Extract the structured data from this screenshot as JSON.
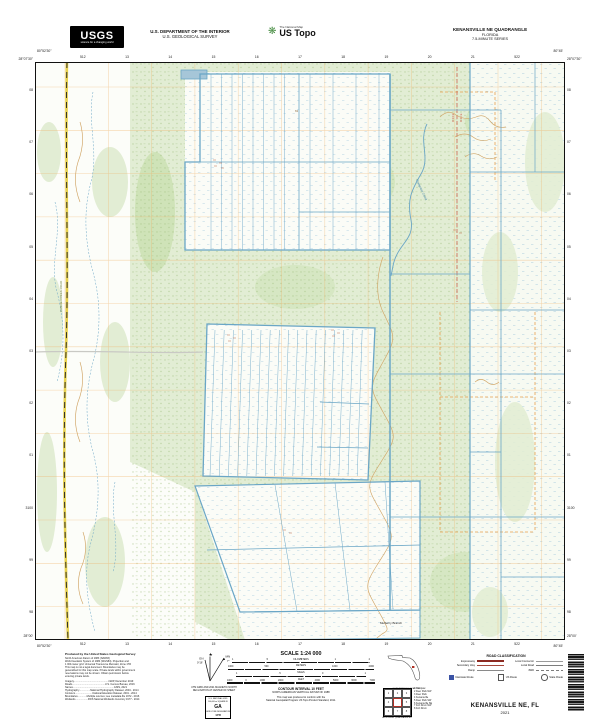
{
  "header": {
    "usgs_logo_text": "USGS",
    "usgs_tagline": "science for a changing world",
    "agency_line1": "U.S. DEPARTMENT OF THE INTERIOR",
    "agency_line2": "U.S. GEOLOGICAL SURVEY",
    "ustopo_brand_small": "The National Map",
    "ustopo_brand_large": "US Topo",
    "quad_title_line1": "KENANSVILLE NE QUADRANGLE",
    "quad_title_line2": "FLORIDA",
    "quad_title_line3": "7.5-MINUTE SERIES"
  },
  "map": {
    "corner_coords": {
      "top_left_lat": "28°07'30\"",
      "top_left_lon": "80°52'30\"",
      "top_right_lat": "28°07'30\"",
      "top_right_lon": "80°45'",
      "bottom_left_lat": "28°00'",
      "bottom_left_lon": "80°52'30\"",
      "bottom_right_lat": "28°00'",
      "bottom_right_lon": "80°45'"
    },
    "edge_labels": {
      "top": [
        "512",
        "13",
        "14",
        "15",
        "16",
        "17",
        "18",
        "19",
        "20",
        "21",
        "522"
      ],
      "bottom": [
        "512",
        "13",
        "14",
        "15",
        "16",
        "17",
        "18",
        "19",
        "20",
        "21",
        "522"
      ],
      "left": [
        "08",
        "07",
        "06",
        "05",
        "04",
        "03",
        "02",
        "01",
        "3100",
        "99",
        "98"
      ],
      "right": [
        "08",
        "07",
        "06",
        "05",
        "04",
        "03",
        "02",
        "01",
        "3100",
        "99",
        "98"
      ]
    },
    "labels": {
      "road_name": "CANOE CREEK ROAD",
      "creek_name": "Crabgrass Creek",
      "branch_name": "Mulberry Branch",
      "spot_elevation": "63",
      "range_left": "R 34 E",
      "range_right": "R 35 E"
    }
  },
  "footer": {
    "produced_by": {
      "title": "Produced by the United States Geological Survey",
      "body_lines": [
        "North American Datum of 1983 (NAD83)",
        "World Geodetic System of 1984 (WGS84). Projection and",
        "1 000-meter grid: Universal Transverse Mercator, Zone 17R",
        "This map is not a legal document. Boundaries may be",
        "generalized for this map scale. Private lands within government",
        "reservations may not be shown. Obtain permission before",
        "entering private lands."
      ],
      "source_lines": [
        "Imagery..................................................NAIP, December 2019",
        "Roads...............................................U.S. Census Bureau, 2016",
        "Names...........................................................GNIS, 2021",
        "Hydrography................National Hydrography Dataset, 2004 - 2014",
        "Contours.........................National Elevation Dataset, 2001 - 2014",
        "Boundaries.............Multiple sources; see metadata file 1972 - 2016",
        "Wetlands..................FWS National Wetlands Inventory 1977 - 2014"
      ]
    },
    "declination": {
      "star_label": "★",
      "gn_label": "GN",
      "gn_value": "0°16'",
      "mn_label": "MN",
      "mn_value": "7°",
      "caption_line1": "UTM GRID AND 2021 MAGNETIC NORTH",
      "caption_line2": "DECLINATION AT CENTER OF SHEET"
    },
    "usng": {
      "line1": "U.S. NATIONAL GRID",
      "line2": "100,000-m SQUARE ID",
      "square_id": "GA",
      "line3": "GRID ZONE DESIGNATION",
      "zone": "17R"
    },
    "scale": {
      "title": "SCALE 1:24 000",
      "bars": [
        {
          "unit": "KILOMETERS",
          "ticks": [
            "1",
            ".5",
            "0",
            "1",
            "2"
          ]
        },
        {
          "unit": "METERS",
          "ticks": [
            "1000",
            "500",
            "0",
            "1000",
            "2000"
          ]
        },
        {
          "unit": "MILES",
          "ticks": [
            "1",
            ".5",
            "0",
            "1"
          ]
        },
        {
          "unit": "FEET",
          "ticks": [
            "1000",
            "0",
            "1000",
            "2000",
            "3000",
            "4000",
            "5000",
            "6000",
            "7000"
          ]
        }
      ],
      "contour_line1": "CONTOUR INTERVAL 10 FEET",
      "contour_line2": "NORTH AMERICAN VERTICAL DATUM OF 1988",
      "standard_line1": "This map was produced to conform with the",
      "standard_line2": "National Geospatial Program US Topo Product Standard, 2011."
    },
    "location_inset": {
      "caption": "QUADRANGLE LOCATION"
    },
    "adjoining": {
      "caption": "ADJOINING QUADRANGLES",
      "names": [
        "Holopaw",
        "Deer Park NW",
        "Deer Park",
        "Kenansville",
        "Deer Park SW",
        "Kenansville SE",
        "Fort Drum NW",
        "Fort Drum"
      ]
    },
    "road_class": {
      "title": "ROAD CLASSIFICATION",
      "left": [
        "Expressway",
        "Secondary Hwy",
        "Ramp"
      ],
      "right": [
        "Local Connector",
        "Local Road",
        "4WD"
      ],
      "shields": [
        "Interstate Route",
        "US Route",
        "State Route"
      ]
    },
    "sheet_title": "KENANSVILLE NE, FL",
    "sheet_year": "2021"
  },
  "colors": {
    "canal_blue": "#6aa6c6",
    "vegetation_green": "#e2edd4",
    "grid_orange": "#f0ae62",
    "contour_brown": "#d0a464",
    "expressway_red": "#8c2a22",
    "interstate_blue": "#3b53a5",
    "road_yellow": "#e8d24e"
  }
}
